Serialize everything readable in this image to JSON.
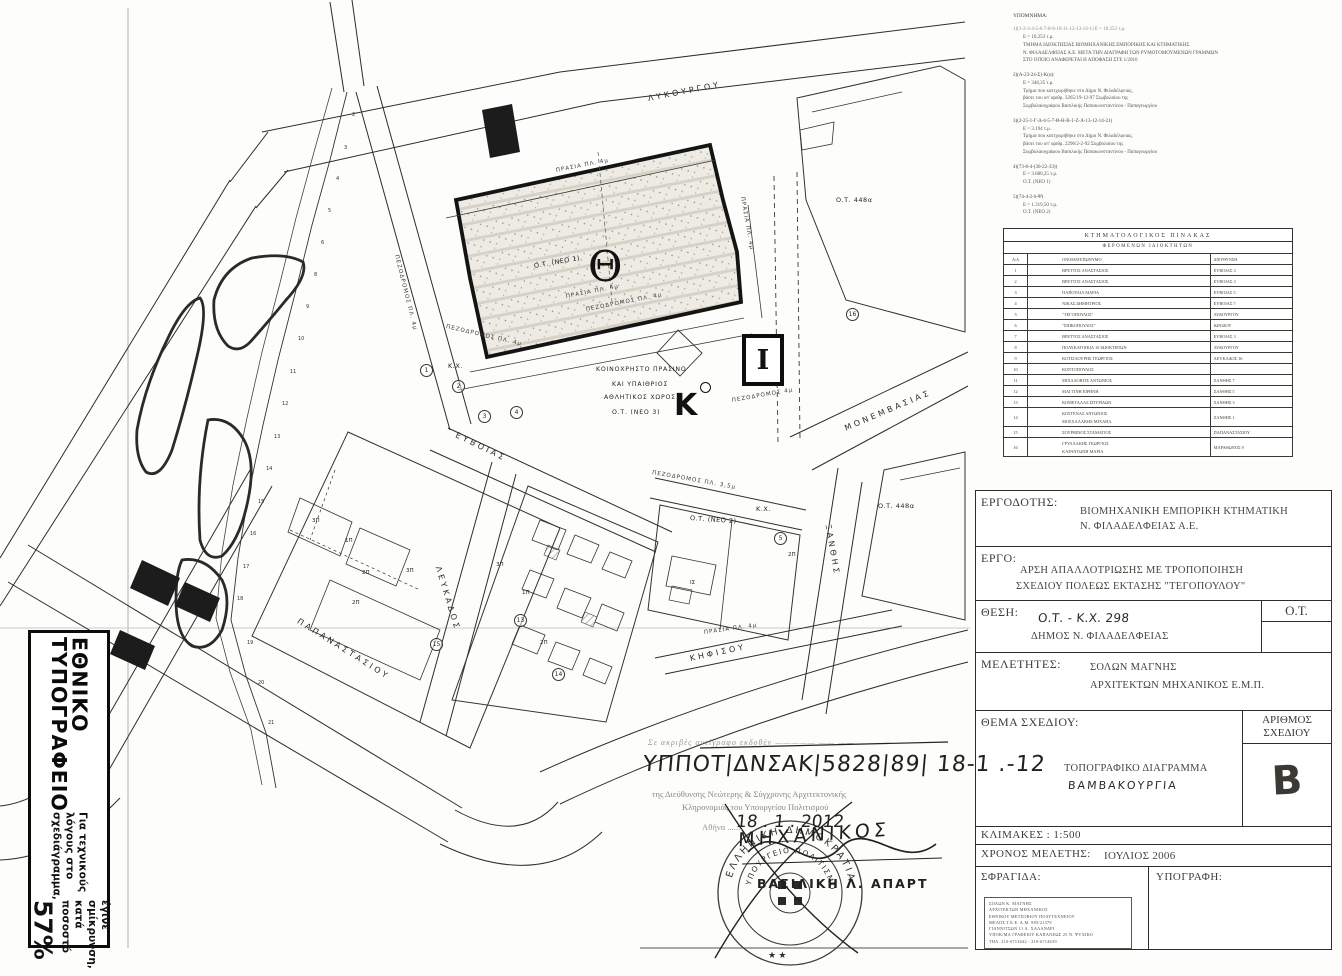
{
  "left_box": {
    "title": "ΕΘΝΙΚΟ ΤΥΠΟΓΡΑΦΕΙΟ",
    "note_line1": "Για τεχνικούς λόγους στο σχεδιάγραμμα,",
    "note_line2": "έγινε σμίκρυνση, κατά ποσοστό",
    "percent": "57%"
  },
  "notes": {
    "title": "ΥΠΟΜΝΗΜΑ:",
    "groups": [
      {
        "h": "1)(1-2-3-4-5-6-7-8-9-10-11-12-13-14-1)  Ε = 10.253 τ.μ.",
        "lines": [
          "Ε = 10.253 τ.μ.",
          "ΤΜΗΜΑ ΙΔΙΟΚΤΗΣΙΑΣ ΒΙΟΜΗΧΑΝΙΚΗΣ ΕΜΠΟΡΙΚΗΣ ΚΑΙ ΚΤΗΜΑΤΙΚΗΣ",
          "Ν. ΦΙΛΑΔΕΛΦΕΙΑΣ Α.Ε. ΜΕΤΑ ΤΗΝ ΔΙΑΓΡΑΦΗ ΤΩΝ ΡΥΜΟΤΟΜΟΥΜΕΝΩΝ ΓΡΑΜΜΩΝ",
          "ΣΤΟ ΟΠΟΙΟ ΑΝΑΦΕΡΕΤΑΙ Η ΑΠΟΦΑΣΗ ΣΤΕ 1/2010"
        ]
      },
      {
        "h": "2)(Α-23-24-Σ)-Κ(α):",
        "lines": [
          "Ε = 348,35 τ.μ.",
          "Τμήμα που κατεχωρήθηκε στο Δήμο Ν. Φιλαδέλφειας,",
          "βάσει του υπ' αριθμ. 3265/19-12-97 Συμβολαίου της",
          "Συμβολαιογράφου Βασιλικής Παπακωνσταντίνου - Παπαγεωργίου"
        ]
      },
      {
        "h": "3)(2-25-1-Γ-Δ-4-5-7-Θ-Η-Β-1-Ζ-Α-13-12-14-21)",
        "lines": [
          "Ε = 3.194 τ.μ.",
          "Τμήμα που κατεχωρήθηκε στο Δήμο Ν. Φιλαδέλφειας,",
          "βάσει του υπ' αριθμ. 2296/2-2-92 Συμβολαίου της",
          "Συμβολαιογράφου Βασιλικής Παπακωνσταντίνου - Παπαγεωργίου"
        ]
      },
      {
        "h": "4)(73-8-4-(30-22-33))",
        "lines": [
          "Ε = 3.680,25 τ.μ.",
          "Ο.Τ. (ΝΕΟ 1)"
        ]
      },
      {
        "h": "5)(74-4-2-6-Ψ)",
        "lines": [
          "Ε = 1.319,50 τ.μ.",
          "Ο.Τ. (ΝΕΟ 2)"
        ]
      }
    ]
  },
  "cadastral_table": {
    "caption1": "ΚΤΗΜΑΤΟΛΟΓΙΚΟΣ ΠΙΝΑΚΑΣ",
    "caption2": "ΦΕΡΟΜΕΝΩΝ ΙΔΙΟΚΤΗΤΩΝ",
    "columns": [
      "Α/Α",
      "ΟΝΟΜΑΤΕΠΩΝΥΜΟ",
      "ΔΙΕΥΘΥΝΣΗ"
    ],
    "rows": [
      {
        "no": "1",
        "name": "ΒΡΕΤΤΟΣ ΑΝΑΣΤΑΣΙΟΣ",
        "name2": "",
        "addr": "ΕΥΒΟΙΑΣ 3"
      },
      {
        "no": "2",
        "name": "ΒΡΕΤΤΟΣ ΑΝΑΣΤΑΣΙΟΣ",
        "name2": "",
        "addr": "ΕΥΒΟΙΑΣ 3"
      },
      {
        "no": "3",
        "name": "ΠΑΠΟΥΛΙΑ ΜΑΡΙΑ",
        "name2": "",
        "addr": "ΕΥΒΟΙΑΣ 5"
      },
      {
        "no": "4",
        "name": "ΝΙΚΑΣ ΔΗΜΗΤΡΙΟΣ",
        "name2": "",
        "addr": "ΕΥΒΟΙΑΣ 7"
      },
      {
        "no": "5",
        "name": "\"ΤΕΓΟΠΟΥΛΟΣ\"",
        "name2": "",
        "addr": "ΛΥΚΟΥΡΓΟΥ"
      },
      {
        "no": "6",
        "name": "\"ΣΠΙΚΟΠΟΥΛΟΣ\"",
        "name2": "",
        "addr": "ΙΩΝΙΔΟΥ"
      },
      {
        "no": "7",
        "name": "ΒΡΕΤΤΟΣ ΑΝΑΣΤΑΣΙΟΣ",
        "name2": "",
        "addr": "ΕΥΒΟΙΑΣ 3"
      },
      {
        "no": "8",
        "name": "ΠΟΛΥΚΑΤΟΙΚΙΑ 10 ΙΔΙΟΚΤΗΤΩΝ",
        "name2": "",
        "addr": "ΛΥΚΟΥΡΓΟΥ"
      },
      {
        "no": "9",
        "name": "ΚΟΤΣΙΛΟΥΡΗΣ ΓΕΩΡΓΙΟΣ",
        "name2": "",
        "addr": "ΛΕΥΚΑΔΟΣ 16"
      },
      {
        "no": "10",
        "name": "ΚΟΝΤΟΠΟΥΛΟΣ",
        "name2": "",
        "addr": ""
      },
      {
        "no": "11",
        "name": "ΜΙΧΑΛΟΒΙΤΣ ΑΝΤΩΝΙΟΣ",
        "name2": "",
        "addr": "ΞΑΝΘΗΣ 7"
      },
      {
        "no": "12",
        "name": "ΜΑΓΓΙΝΗ ΕΙΡΗΝΗ",
        "name2": "",
        "addr": "ΞΑΝΘΗΣ 5"
      },
      {
        "no": "13",
        "name": "ΚΟΜΕΤΑΛΑΣ ΣΠΥΡΙΔΩΝ",
        "name2": "",
        "addr": "ΞΑΝΘΗΣ 3"
      },
      {
        "no": "14",
        "name": "ΚΟΣΤΕΝΑΣ ΑΝΤΩΝΙΟΣ",
        "name2": "ΜΟΣΧΑΛΑΚΗΣ ΜΙΧΑΗΛ",
        "addr": "ΞΑΝΘΗΣ 1"
      },
      {
        "no": "15",
        "name": "ΣΟΥΡΒΙΝΟΣ ΣΤΑΜΑΤΙΟΣ",
        "name2": "",
        "addr": "ΠΑΠΑΝΑΣΤΑΣΙΟΥ"
      },
      {
        "no": "16",
        "name": "ΓΡΥΛΛΑΚΗΣ ΓΕΩΡΓΙΟΣ",
        "name2": "ΚΑΡΑΝΤΩΝΗ ΜΑΡΙΑ",
        "addr": "ΜΑΡΑΘΩΝΟΣ 9"
      }
    ]
  },
  "title_block": {
    "ergodotis_label": "ΕΡΓΟΔΟΤΗΣ:",
    "ergodotis_line1": "ΒΙΟΜΗΧΑΝΙΚΗ ΕΜΠΟΡΙΚΗ ΚΤΗΜΑΤΙΚΗ",
    "ergodotis_line2": "Ν. ΦΙΛΑΔΕΛΦΕΙΑΣ Α.Ε.",
    "ergo_label": "ΕΡΓΟ:",
    "ergo_line1": "ΑΡΣΗ ΑΠΑΛΛΟΤΡΙΩΣΗΣ ΜΕ ΤΡΟΠΟΠΟΙΗΣΗ",
    "ergo_line2": "ΣΧΕΔΙΟΥ ΠΟΛΕΩΣ ΕΚΤΑΣΗΣ \"ΤΕΓΟΠΟΥΛΟΥ\"",
    "thesi_label": "ΘΕΣΗ:",
    "thesi_hand": "Ο.Τ. - Κ.Χ. 298",
    "thesi_line2": "ΔΗΜΟΣ Ν. ΦΙΛΑΔΕΛΦΕΙΑΣ",
    "thesi_ot": "Ο.Τ.",
    "meletites_label": "ΜΕΛΕΤΗΤΕΣ:",
    "meletites_line1": "ΣΟΛΩΝ  ΜΑΓΝΗΣ",
    "meletites_line2": "ΑΡΧΙΤΕΚΤΩΝ ΜΗΧΑΝΙΚΟΣ Ε.Μ.Π.",
    "thema_label": "ΘΕΜΑ ΣΧΕΔΙΟΥ:",
    "thema_line1": "ΤΟΠΟΓΡΑΦΙΚΟ ΔΙΑΓΡΑΜΜΑ",
    "thema_hand": "ΒΑΜΒΑΚΟΥΡΓΙΑ",
    "arithmos_label1": "ΑΡΙΘΜΟΣ",
    "arithmos_label2": "ΣΧΕΔΙΟΥ",
    "arithmos_value": "Β",
    "klimakes": "ΚΛΙΜΑΚΕΣ : 1:500",
    "xronos_label": "ΧΡΟΝΟΣ ΜΕΛΕΤΗΣ:",
    "xronos_value": "ΙΟΥΛΙΟΣ 2006",
    "sfragida_label": "ΣΦΡΑΓΙΔΑ:",
    "ypografi_label": "ΥΠΟΓΡΑΦΗ:",
    "seal_lines": [
      "ΣΟΛΩΝ Κ. ΜΑΓΝΗΣ",
      "ΑΡΧΙΤΕΚΤΩΝ ΜΗΧΑΝΙΚΟΣ",
      "ΕΘΝΙΚΟΥ ΜΕΤΣΟΒΙΟΥ ΠΟΛΥΤΕΧΝΕΙΟΥ",
      "ΜΕΛΟΣ Τ.Ε.Ε. Α.Μ. 985/21379",
      "ΓΙΑΝΝΙΤΣΩΝ 11 Α. ΧΑΛΑΝΔΡΙ",
      "ΥΠΟΚ/ΜΑ ΓΡΑΦΕΙΟΥ ΚΑΠΑΝΕΩΣ 25 Ν. ΨΥΧΙΚΟ",
      "ΤΗΛ.  210-6713642  -  210-6714639"
    ]
  },
  "approval": {
    "faint_line": "Σε ακριβές αντίγραφο εκδοθέν —————  ——  ——",
    "hand_ref": "ΥΠΠΟΤ|ΔΝΣΑΚ|5828|89| 18-1 .-12",
    "line1": "της Διεύθυνσης Νεώτερης & Σύγχρονης Αρχιτεκτονικής",
    "line2": "Κληρονομιάς του Υπουργείου Πολιτισμού",
    "city": "Αθήνα .......",
    "hand_date": "18 . 1 . 2012",
    "stamp": {
      "ring1": "ΕΛΛΗΝΙΚΗ  ΔΗΜΟΚΡΑΤΙΑ",
      "ring2": "ΥΠΟΥΡΓΕΙΟ ΠΟΛΙΤΙΣΜΟΥ",
      "stars": "★   ★"
    },
    "hand_word": "ΜΗΧΑΝΙΚΟΣ",
    "name": "ΒΑΣΙΛΙΚΗ  Λ.  ΑΠΑΡΤ"
  },
  "map": {
    "symbols": {
      "theta": "Θ",
      "kappa": "Κ",
      "iota": "Ι"
    },
    "labels": [
      {
        "c": "street",
        "t": "ΛΥΚΟΥΡΓΟΥ",
        "x": 648,
        "y": 94,
        "r": -11
      },
      {
        "c": "street",
        "t": "ΜΟΝΕΜΒΑΣΙΑΣ",
        "x": 845,
        "y": 424,
        "r": -23
      },
      {
        "c": "street",
        "t": "ΕΥΒΟΙΑΣ",
        "x": 456,
        "y": 430,
        "r": 26
      },
      {
        "c": "street",
        "t": "ΛΕΥΚΑΔΟΣ",
        "x": 438,
        "y": 562,
        "r": 73
      },
      {
        "c": "street",
        "t": "ΞΑΝΘΗΣ",
        "x": 828,
        "y": 520,
        "r": 80
      },
      {
        "c": "street",
        "t": "ΠΑΠΑΝΑΣΤΑΣΙΟΥ",
        "x": 298,
        "y": 616,
        "r": 32
      },
      {
        "c": "street",
        "t": "ΚΗΦΙΣΟΥ",
        "x": 690,
        "y": 654,
        "r": -12
      },
      {
        "c": "ann",
        "t": "ΠΡΑΣΙΑ ΠΛ. 4μ",
        "x": 556,
        "y": 168,
        "r": -11
      },
      {
        "c": "ann",
        "t": "ΠΡΑΣΙΑ ΠΛ. 4μ",
        "x": 566,
        "y": 294,
        "r": -11
      },
      {
        "c": "ann",
        "t": "ΠΕΖΟΔΡΟΜΟΣ ΠΛ. 4μ",
        "x": 586,
        "y": 307,
        "r": -11
      },
      {
        "c": "ann",
        "t": "ΠΡΑΣΙΑ ΠΛ. 4μ",
        "x": 742,
        "y": 194,
        "r": 80
      },
      {
        "c": "ann",
        "t": "ΠΕΖΟΔΡΟΜΟΣ ΠΛ. 4μ",
        "x": 396,
        "y": 252,
        "r": 76
      },
      {
        "c": "ann",
        "t": "ΠΕΖΟΔΡΟΜΟΣ ΠΛ. 4μ",
        "x": 446,
        "y": 324,
        "r": 13
      },
      {
        "c": "ann",
        "t": "ΠΕΖΟΔΡΟΜΟΣ 4μ",
        "x": 732,
        "y": 398,
        "r": -10
      },
      {
        "c": "ann",
        "t": "ΠΕΖΟΔΡΟΜΟΣ ΠΛ. 3,5μ",
        "x": 652,
        "y": 470,
        "r": 10
      },
      {
        "c": "ann",
        "t": "ΠΡΑΣΙΑ ΠΛ. 4μ",
        "x": 704,
        "y": 630,
        "r": -8
      },
      {
        "c": "area",
        "t": "Ο.Τ. (ΝΕΟ 1)",
        "x": 534,
        "y": 262,
        "r": -10
      },
      {
        "c": "area",
        "t": "Ο.Τ. (ΝΕΟ 2)",
        "x": 690,
        "y": 514,
        "r": 4
      },
      {
        "c": "area",
        "t": "Ο.Τ. 448α",
        "x": 836,
        "y": 196,
        "r": 0
      },
      {
        "c": "area",
        "t": "Ο.Τ. 448α",
        "x": 878,
        "y": 502,
        "r": 0
      },
      {
        "c": "area",
        "t": "Κ.Χ.",
        "x": 448,
        "y": 362,
        "r": 0
      },
      {
        "c": "area",
        "t": "Κ.Χ.",
        "x": 756,
        "y": 505,
        "r": 0
      },
      {
        "c": "ctr",
        "t": "ΚΟΙΝΟΧΡΗΣΤΟ ΠΡΑΣΙΝΟ",
        "x": 596,
        "y": 366,
        "r": 0
      },
      {
        "c": "ctr",
        "t": "ΚΑΙ ΥΠΑΙΘΡΙΟΣ",
        "x": 612,
        "y": 381,
        "r": 0
      },
      {
        "c": "ctr",
        "t": "ΑΘΛΗΤΙΚΟΣ ΧΩΡΟΣ",
        "x": 604,
        "y": 394,
        "r": 0
      },
      {
        "c": "ctr",
        "t": "Ο.Τ. (ΝΕΟ 3)",
        "x": 612,
        "y": 409,
        "r": 0
      },
      {
        "c": "flr",
        "t": "3Π",
        "x": 312,
        "y": 518,
        "r": 0
      },
      {
        "c": "flr",
        "t": "1Π",
        "x": 345,
        "y": 538,
        "r": 0
      },
      {
        "c": "flr",
        "t": "2Π",
        "x": 362,
        "y": 570,
        "r": 0
      },
      {
        "c": "flr",
        "t": "2Π",
        "x": 352,
        "y": 600,
        "r": 0
      },
      {
        "c": "flr",
        "t": "3Π",
        "x": 406,
        "y": 568,
        "r": 0
      },
      {
        "c": "flr",
        "t": "3Π",
        "x": 496,
        "y": 562,
        "r": 0
      },
      {
        "c": "flr",
        "t": "1Π",
        "x": 522,
        "y": 590,
        "r": 0
      },
      {
        "c": "flr",
        "t": "2Π",
        "x": 788,
        "y": 552,
        "r": 0
      },
      {
        "c": "flr",
        "t": "2Π",
        "x": 540,
        "y": 640,
        "r": 0
      },
      {
        "c": "flr",
        "t": "ΙΣ",
        "x": 690,
        "y": 580,
        "r": 0
      },
      {
        "c": "circ",
        "t": "1",
        "x": 420,
        "y": 364,
        "r": 0
      },
      {
        "c": "circ",
        "t": "2",
        "x": 452,
        "y": 380,
        "r": 0
      },
      {
        "c": "circ",
        "t": "3",
        "x": 478,
        "y": 410,
        "r": 0
      },
      {
        "c": "circ",
        "t": "4",
        "x": 510,
        "y": 406,
        "r": 0
      },
      {
        "c": "circ",
        "t": "5",
        "x": 774,
        "y": 532,
        "r": 0
      },
      {
        "c": "circ",
        "t": "16",
        "x": 846,
        "y": 308,
        "r": 0
      },
      {
        "c": "circ",
        "t": "15",
        "x": 430,
        "y": 638,
        "r": 0
      },
      {
        "c": "circ",
        "t": "13",
        "x": 514,
        "y": 614,
        "r": 0
      },
      {
        "c": "circ",
        "t": "14",
        "x": 552,
        "y": 668,
        "r": 0
      },
      {
        "c": "vtx",
        "t": "2",
        "x": 352,
        "y": 112,
        "r": 0
      },
      {
        "c": "vtx",
        "t": "3",
        "x": 344,
        "y": 145,
        "r": 0
      },
      {
        "c": "vtx",
        "t": "4",
        "x": 336,
        "y": 176,
        "r": 0
      },
      {
        "c": "vtx",
        "t": "5",
        "x": 328,
        "y": 208,
        "r": 0
      },
      {
        "c": "vtx",
        "t": "6",
        "x": 321,
        "y": 240,
        "r": 0
      },
      {
        "c": "vtx",
        "t": "8",
        "x": 314,
        "y": 272,
        "r": 0
      },
      {
        "c": "vtx",
        "t": "9",
        "x": 306,
        "y": 304,
        "r": 0
      },
      {
        "c": "vtx",
        "t": "10",
        "x": 298,
        "y": 336,
        "r": 0
      },
      {
        "c": "vtx",
        "t": "11",
        "x": 290,
        "y": 369,
        "r": 0
      },
      {
        "c": "vtx",
        "t": "12",
        "x": 282,
        "y": 401,
        "r": 0
      },
      {
        "c": "vtx",
        "t": "13",
        "x": 274,
        "y": 434,
        "r": 0
      },
      {
        "c": "vtx",
        "t": "14",
        "x": 266,
        "y": 466,
        "r": 0
      },
      {
        "c": "vtx",
        "t": "15",
        "x": 258,
        "y": 499,
        "r": 0
      },
      {
        "c": "vtx",
        "t": "16",
        "x": 250,
        "y": 531,
        "r": 0
      },
      {
        "c": "vtx",
        "t": "17",
        "x": 243,
        "y": 564,
        "r": 0
      },
      {
        "c": "vtx",
        "t": "18",
        "x": 237,
        "y": 596,
        "r": 0
      },
      {
        "c": "vtx",
        "t": "19",
        "x": 247,
        "y": 640,
        "r": 0
      },
      {
        "c": "vtx",
        "t": "20",
        "x": 258,
        "y": 680,
        "r": 0
      },
      {
        "c": "vtx",
        "t": "21",
        "x": 268,
        "y": 720,
        "r": 0
      }
    ]
  }
}
